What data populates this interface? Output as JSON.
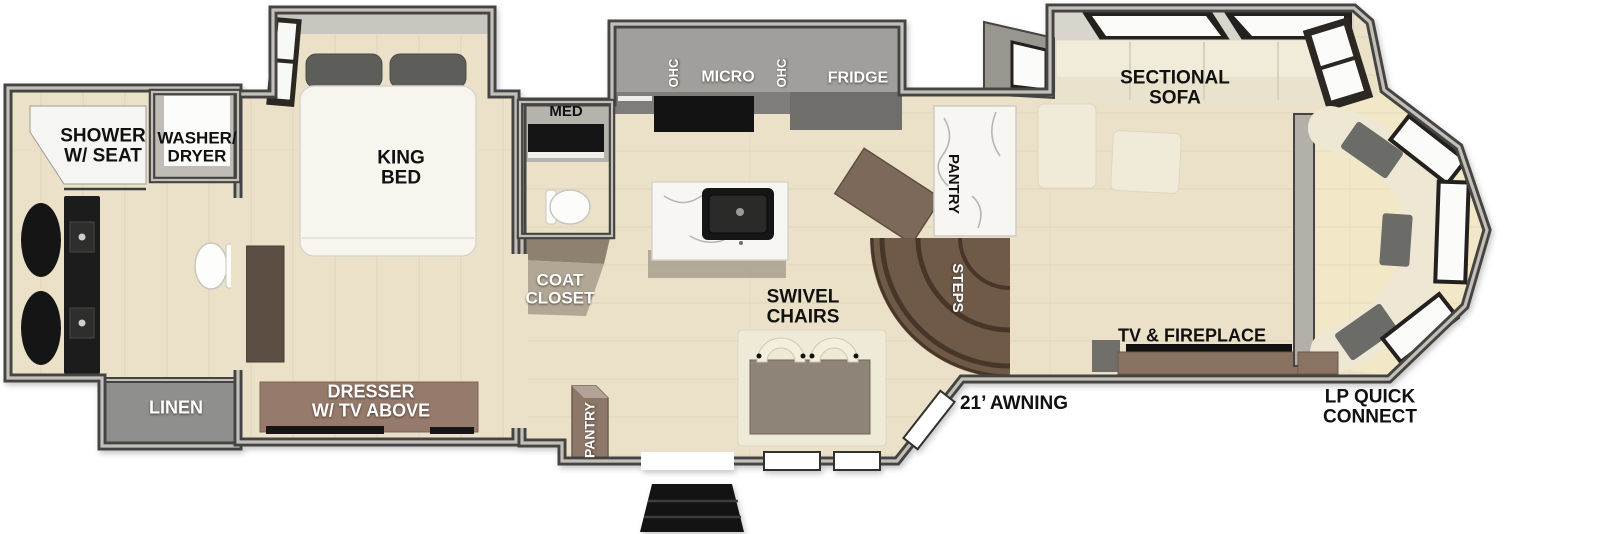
{
  "labels": {
    "shower": "SHOWER\nW/ SEAT",
    "washer_dryer": "WASHER/\nDRYER",
    "linen": "LINEN",
    "king_bed": "KING\nBED",
    "dresser": "DRESSER\nW/ TV ABOVE",
    "med": "MED",
    "coat_closet": "COAT\nCLOSET",
    "ohc_left": "OHC",
    "micro": "MICRO",
    "ohc_right": "OHC",
    "fridge": "FRIDGE",
    "pantry_tall": "PANTRY",
    "steps": "STEPS",
    "swivel_chairs": "SWIVEL\nCHAIRS",
    "entry_pantry": "PANTRY",
    "sectional_sofa": "SECTIONAL\nSOFA",
    "tv_fireplace": "TV & FIREPLACE",
    "awning": "21’ AWNING",
    "lp_quick_connect": "LP QUICK\nCONNECT"
  },
  "colors": {
    "background": "#ffffff",
    "wall_dark": "#454442",
    "wall_top_light": "#c3c0b9",
    "floor_tan": "#ebe1c9",
    "bay_floor": "#f2e8c8",
    "slide_gray": "#a09f9b",
    "appliance_black": "#131313",
    "marble_white": "#f7f6f3",
    "steps_brown": "#6f5947",
    "entry_pantry_brown": "#8d7768",
    "dresser_brown": "#967a6b",
    "linen_gray": "#8f8f8d",
    "sofa_cream": "#f1ebd9",
    "pillow_gray": "#5d5d5a",
    "label_black": "#111111",
    "label_white": "#ffffff"
  }
}
